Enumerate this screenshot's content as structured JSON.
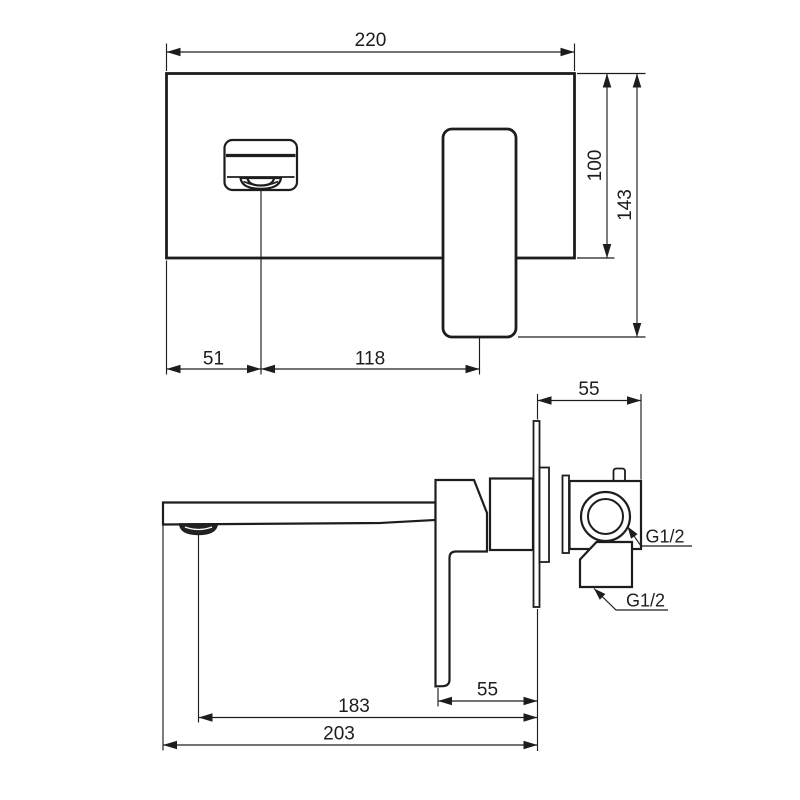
{
  "drawing": {
    "type": "technical-drawing",
    "subject": "wall-mounted-basin-mixer",
    "background": "#ffffff",
    "line_color": "#1d1d1d",
    "front_view": {
      "plate_width_label": "220",
      "plate_height_label": "100",
      "total_height_label": "143",
      "spout_offset_label": "51",
      "spout_to_handle_label": "118"
    },
    "side_view": {
      "body_depth_label": "55",
      "lever_to_wall_label": "55",
      "aerator_reach_label": "183",
      "spout_reach_label": "203",
      "upper_connection_label": "G1/2",
      "lower_connection_label": "G1/2"
    }
  }
}
